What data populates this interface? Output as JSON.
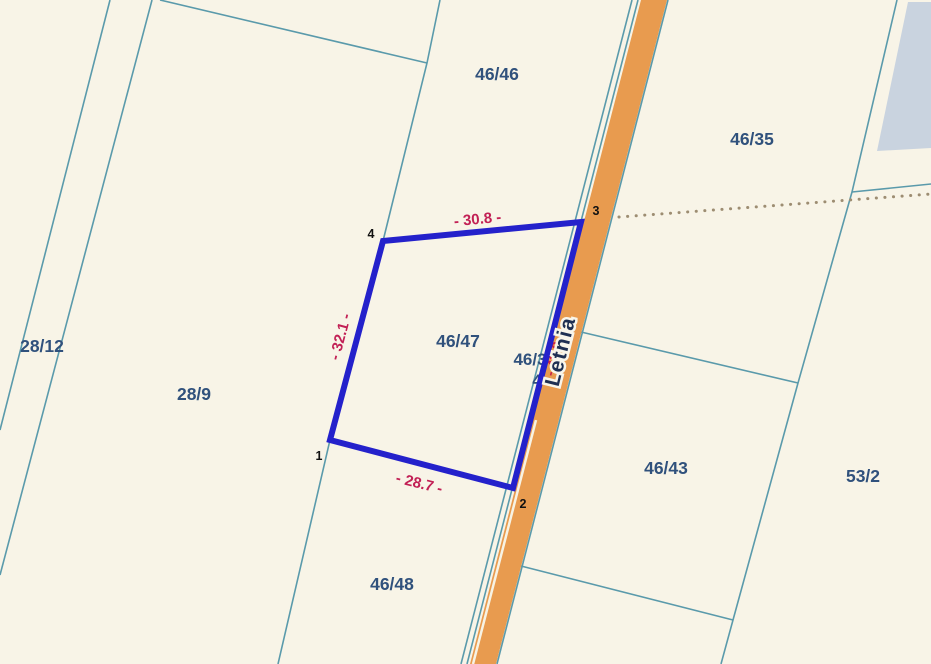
{
  "map": {
    "type": "cadastral-parcel-map",
    "street": {
      "name": "Letnia"
    },
    "parcels": [
      {
        "label": "46/46"
      },
      {
        "label": "46/35"
      },
      {
        "label": "28/12"
      },
      {
        "label": "28/9"
      },
      {
        "label": "46/47"
      },
      {
        "label": "46/43"
      },
      {
        "label": "53/2"
      },
      {
        "label": "46/48"
      }
    ],
    "hidden_parcel_fragments": [
      {
        "label": "46/3"
      },
      {
        "label": "4"
      }
    ],
    "selection": {
      "parcel": "46/47",
      "vertex_labels": {
        "v1": "1",
        "v2": "2",
        "v3": "3",
        "v4": "4"
      },
      "dimensions": {
        "top": "- 30.8 -",
        "left": "- 32.1 -",
        "bottom": "- 28.7 -",
        "east": "- 42.8 -"
      }
    },
    "colors": {
      "background": "#f8f4e7",
      "boundary_line": "#5a9aab",
      "road_fill": "#e89b4f",
      "selection_outline": "#2421cb",
      "dimension_text": "#c22055",
      "parcel_label_text": "#30517c",
      "street_label_text": "#1e2f52",
      "building_fill": "#c9d3df",
      "dotted_line": "#9d8d72"
    }
  }
}
